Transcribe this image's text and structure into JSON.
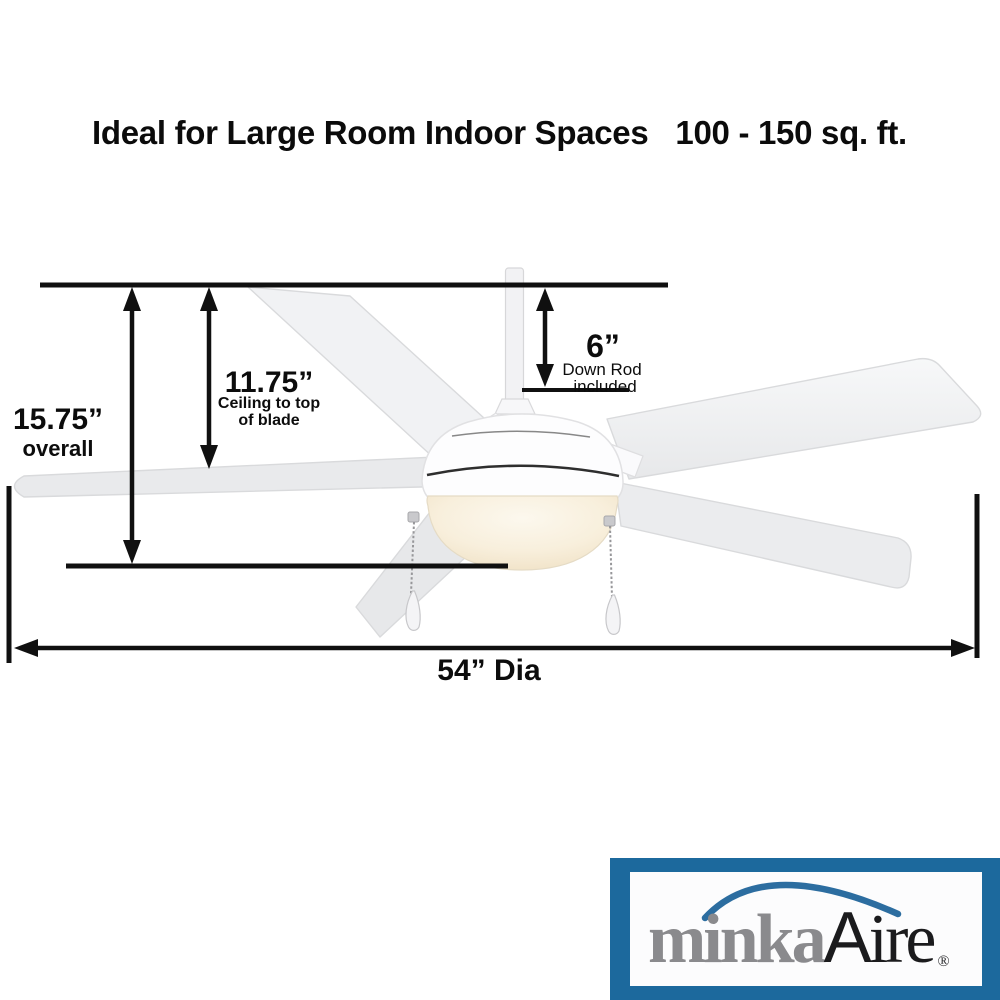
{
  "title": {
    "main": "Ideal for Large Room Indoor Spaces",
    "size_range": "100 - 150 sq. ft."
  },
  "dimensions": {
    "overall": {
      "value": "15.75”",
      "label": "overall"
    },
    "ceiling_to_blade": {
      "value": "11.75”",
      "label_line1": "Ceiling to top",
      "label_line2": "of blade"
    },
    "down_rod": {
      "value": "6”",
      "label_line1": "Down Rod",
      "label_line2": "included"
    },
    "diameter": {
      "value": "54” Dia"
    }
  },
  "brand": {
    "word1": "minka",
    "word2_initial": "A",
    "word2_rest": "ire",
    "registered": "®"
  },
  "colors": {
    "dimension_line": "#101010",
    "brand_frame_blue": "#1C699D",
    "brand_arc_blue": "#2C6DA0",
    "brand_gray": "#8A8A8D",
    "brand_black": "#1B1B1D",
    "fan_white": "#FDFDFE",
    "blade_gray": "#ECEDEF",
    "light_glow_warm": "#F6EBD4"
  }
}
